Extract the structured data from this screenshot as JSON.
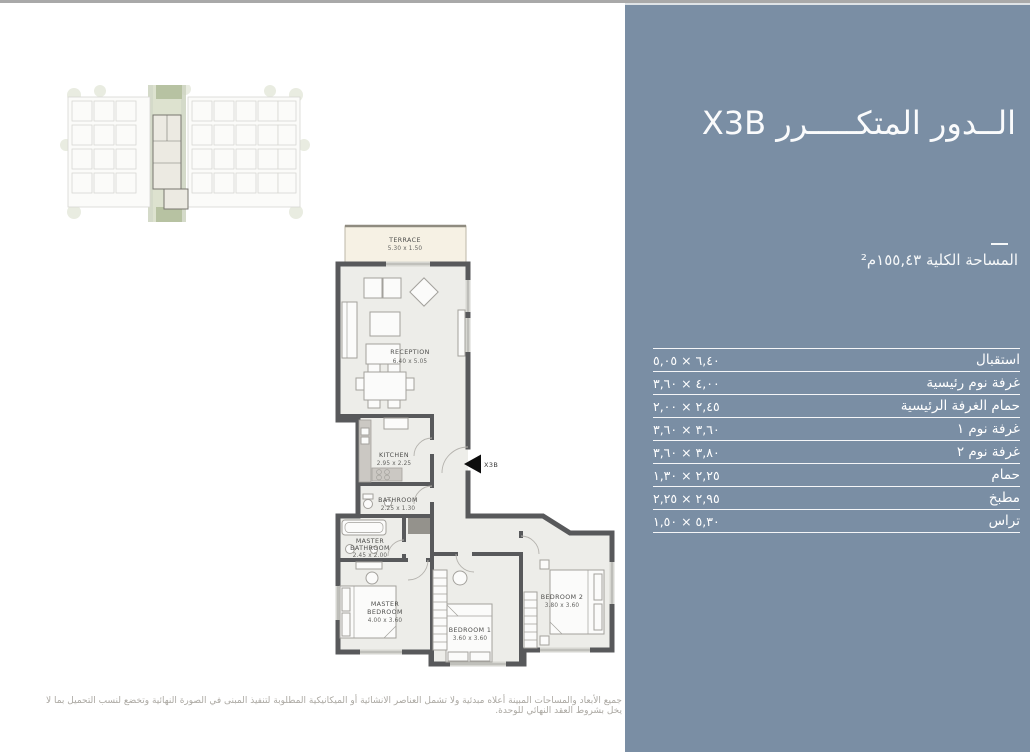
{
  "colors": {
    "panel_bg": "#7A8EA4",
    "panel_text": "#FFFFFF",
    "wall": "#58595B",
    "room_fill": "#EDEDE9",
    "terrace_fill": "#F6F1E4",
    "site_plan_green": "#CDD4BF",
    "disclaimer_text": "#ABA8A2"
  },
  "panel": {
    "title": "الــدور المتكـــــرر X3B",
    "total_area": "المساحة الكلية ١٥٥,٤٣م²",
    "table_rows": [
      {
        "label": "استقبال",
        "value": "٦,٤٠ × ٥,٠٥"
      },
      {
        "label": "غرفة نوم رئيسية",
        "value": "٤,٠٠ × ٣,٦٠"
      },
      {
        "label": "حمام الغرفة الرئيسية",
        "value": "٢,٤٥ × ٢,٠٠"
      },
      {
        "label": "غرفة نوم ١",
        "value": "٣,٦٠ × ٣,٦٠"
      },
      {
        "label": "غرفة نوم ٢",
        "value": "٣,٨٠ × ٣,٦٠"
      },
      {
        "label": "حمام",
        "value": "٢,٢٥ × ١,٣٠"
      },
      {
        "label": "مطبخ",
        "value": "٢,٩٥ × ٢,٢٥"
      },
      {
        "label": "تراس",
        "value": "٥,٣٠ × ١,٥٠"
      }
    ]
  },
  "floorplan": {
    "unit_marker": "X3B",
    "rooms": {
      "terrace": {
        "name": "TERRACE",
        "dims": "5.30 x 1.50"
      },
      "reception": {
        "name": "RECEPTION",
        "dims": "6.40 x 5.05"
      },
      "kitchen": {
        "name": "KITCHEN",
        "dims": "2.95 x 2.25"
      },
      "bathroom": {
        "name": "BATHROOM",
        "dims": "2.25 x 1.30"
      },
      "master_bathroom": {
        "line1": "MASTER",
        "line2": "BATHROOM",
        "dims": "2.45 x 2.00"
      },
      "master_bedroom": {
        "line1": "MASTER",
        "line2": "BEDROOM",
        "dims": "4.00 x 3.60"
      },
      "bedroom1": {
        "name": "BEDROOM 1",
        "dims": "3.60 x 3.60"
      },
      "bedroom2": {
        "name": "BEDROOM 2",
        "dims": "3.80 x 3.60"
      }
    }
  },
  "disclaimer": "جميع الأبعاد والمساحات المبينة أعلاه مبدئية ولا تشمل العناصر الانشائية أو الميكانيكية المطلوبة لتنفيذ المبنى في الصورة النهائية وتخضع لنسب التحميل بما لا يخل بشروط العقد النهائي للوحدة."
}
